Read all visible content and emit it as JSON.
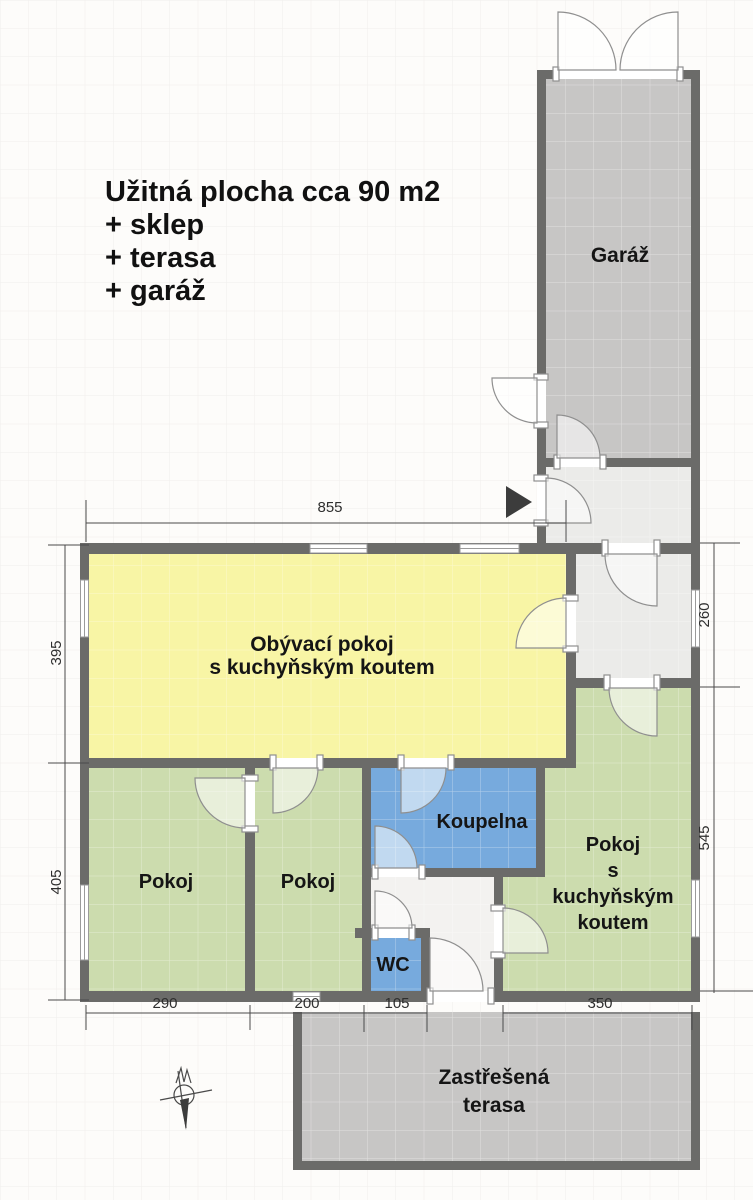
{
  "title_block": {
    "lines": [
      "Užitná plocha cca 90 m2",
      "+ sklep",
      "+ terasa",
      "+ garáž"
    ]
  },
  "rooms": {
    "garage": {
      "label": "Garáž"
    },
    "living_room": {
      "line1": "Obývací pokoj",
      "line2": "s kuchyňským koutem"
    },
    "bedroom_left": {
      "label": "Pokoj"
    },
    "bedroom_middle": {
      "label": "Pokoj"
    },
    "bathroom": {
      "label": "Koupelna"
    },
    "wc": {
      "label": "WC"
    },
    "room_with_kitchenette": {
      "line1": "Pokoj",
      "line2": "s",
      "line3": "kuchyňským",
      "line4": "koutem"
    },
    "covered_terrace": {
      "line1": "Zastřešená",
      "line2": "terasa"
    }
  },
  "dimensions": {
    "top_width": "855",
    "left_upper": "395",
    "left_lower": "405",
    "right_upper": "260",
    "right_lower": "545",
    "bottom_widths": [
      "290",
      "200",
      "105",
      "350"
    ]
  },
  "colors": {
    "wall": "#6b6b69",
    "garage_fill": "#c7c6c5",
    "terrace_fill": "#c7c6c5",
    "hall_fill": "#ebebe9",
    "corridor_fill": "#f3f2f0",
    "living_fill": "#f8f5a5",
    "bedroom_fill": "#ccdcae",
    "bathroom_fill": "#77aadd",
    "entrance_arrow": "#3c3c3c"
  }
}
